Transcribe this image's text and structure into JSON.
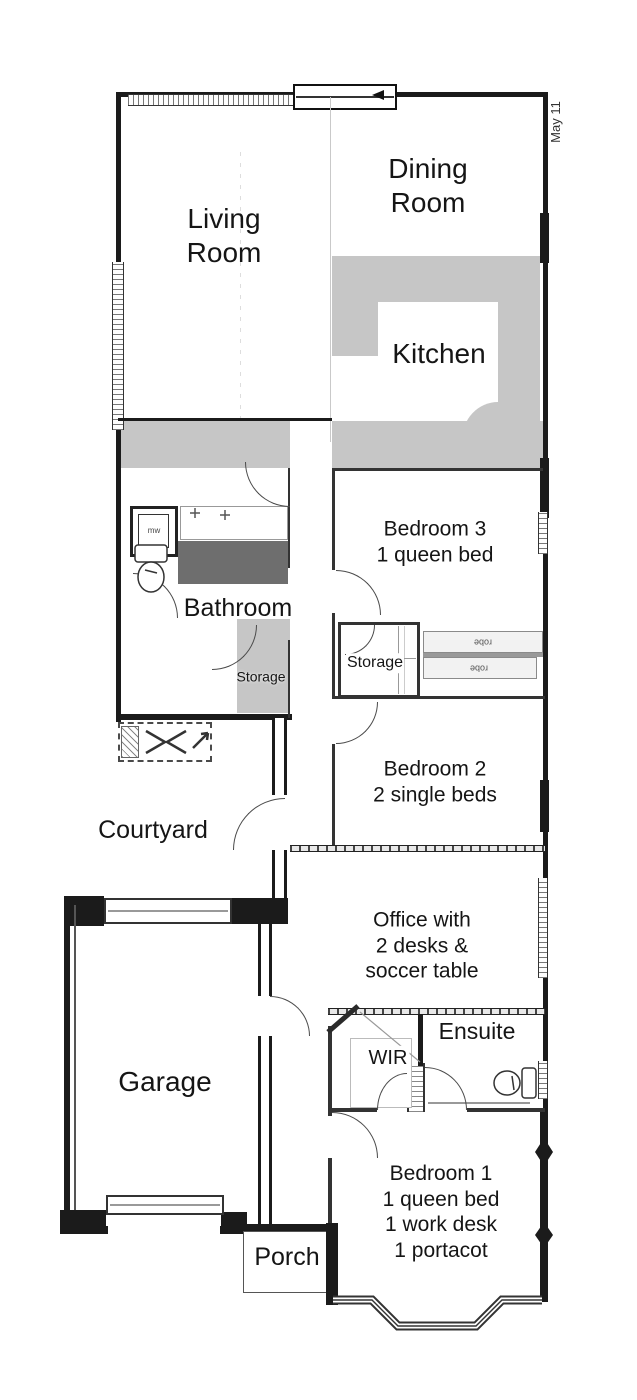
{
  "rooms": {
    "living": "Living\nRoom",
    "dining": "Dining\nRoom",
    "kitchen": "Kitchen",
    "bathroom": "Bathroom",
    "storage_left": "Storage",
    "storage_right": "Storage",
    "bedroom3": "Bedroom 3\n1 queen bed",
    "bedroom2": "Bedroom 2\n2 single beds",
    "courtyard": "Courtyard",
    "office": "Office with\n2 desks &\nsoccer table",
    "garage": "Garage",
    "wir": "WIR",
    "ensuite": "Ensuite",
    "bedroom1": "Bedroom 1\n1 queen bed\n1 work desk\n1 portacot",
    "porch": "Porch"
  },
  "fixtures": {
    "washing_machine": "mw",
    "robe_top": "robe",
    "robe_bottom": "robe"
  },
  "annotations": {
    "date_note": "May 11"
  },
  "colors": {
    "counter_fill": "#c6c6c6",
    "bathtub_fill": "#6e6e6e",
    "wall": "#1b1b1b",
    "background": "#ffffff"
  }
}
